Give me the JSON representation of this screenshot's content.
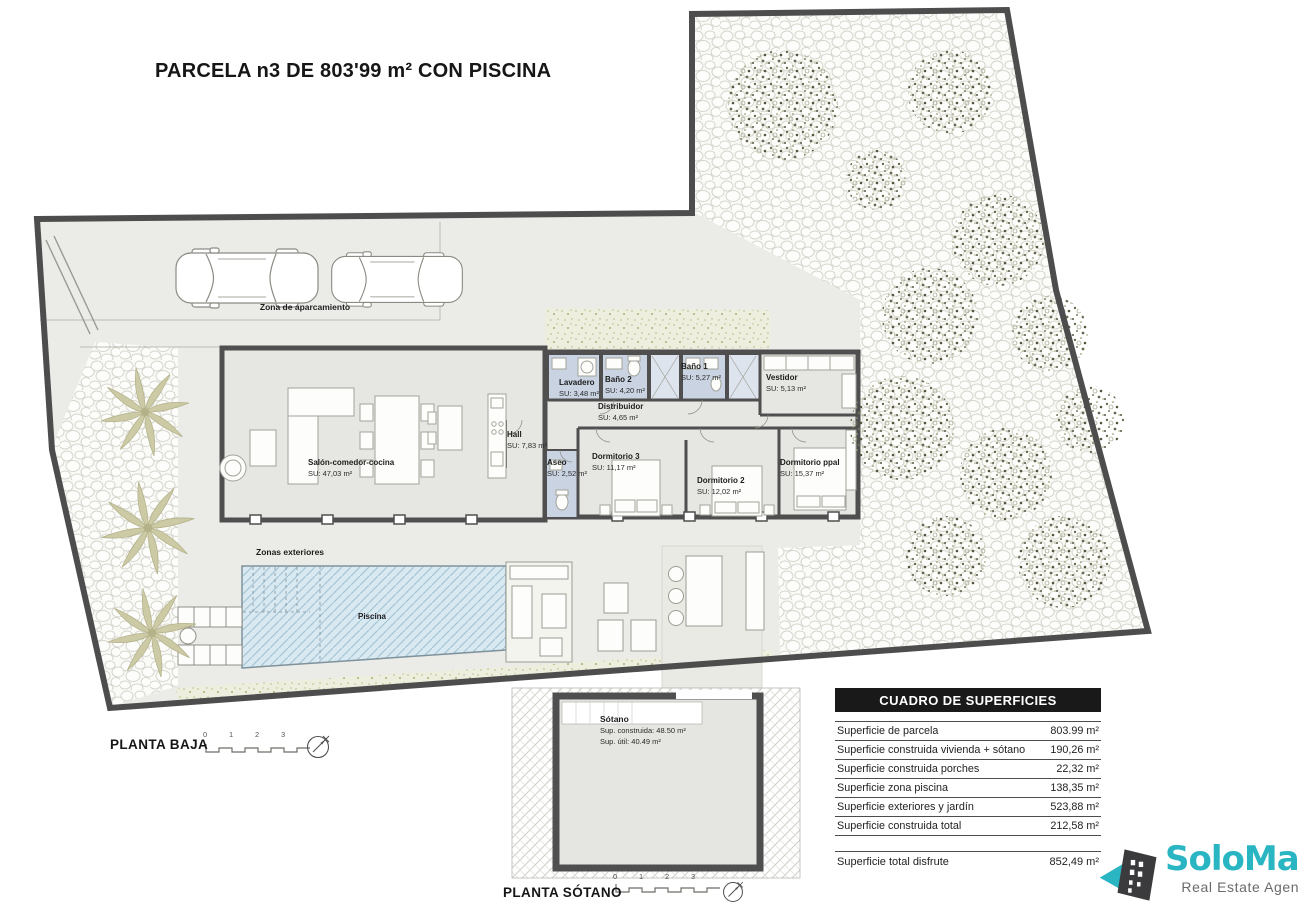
{
  "title": "PARCELA n3 DE 803'99 m² CON PISCINA",
  "plan_labels": {
    "parking": "Zona de aparcamiento",
    "exterior": "Zonas exteriores",
    "pool": "Piscina"
  },
  "rooms": [
    {
      "name": "Salón-comedor-cocina",
      "su": "SU: 47,03 m²"
    },
    {
      "name": "Hall",
      "su": "SU: 7,83 m²"
    },
    {
      "name": "Lavadero",
      "su": "SU: 3,48 m²"
    },
    {
      "name": "Baño 2",
      "su": "SU: 4,20 m²"
    },
    {
      "name": "Baño 1",
      "su": "SU: 5,27 m²"
    },
    {
      "name": "Vestidor",
      "su": "SU: 5,13 m²"
    },
    {
      "name": "Distribuidor",
      "su": "SU: 4,65 m²"
    },
    {
      "name": "Aseo",
      "su": "SU: 2,52 m²"
    },
    {
      "name": "Dormitorio 3",
      "su": "SU: 11,17 m²"
    },
    {
      "name": "Dormitorio 2",
      "su": "SU: 12,02 m²"
    },
    {
      "name": "Dormitorio ppal",
      "su": "SU: 15,37 m²"
    }
  ],
  "basement": {
    "name": "Sótano",
    "line1": "Sup. construida: 48.50 m²",
    "line2": "Sup. útil: 40.49 m²"
  },
  "floor_labels": {
    "ground": "PLANTA BAJA",
    "basement": "PLANTA SÓTANO"
  },
  "scale_ticks": [
    "0",
    "1",
    "2",
    "3"
  ],
  "table": {
    "header": "CUADRO DE SUPERFICIES",
    "rows": [
      {
        "label": "Superficie de parcela",
        "value": "803.99 m²"
      },
      {
        "label": "Superficie construida vivienda + sótano",
        "value": "190,26 m²"
      },
      {
        "label": "Superficie construida porches",
        "value": "22,32 m²"
      },
      {
        "label": "Superficie zona piscina",
        "value": "138,35 m²"
      },
      {
        "label": "Superficie exteriores y jardín",
        "value": "523,88 m²"
      },
      {
        "label": "Superficie construida total",
        "value": "212,58 m²"
      }
    ],
    "total_row": {
      "label": "Superficie total disfrute",
      "value": "852,49 m²"
    }
  },
  "logo": {
    "name": "SoloMar",
    "tagline": "Real Estate Agency",
    "teal": "#2ab5c3",
    "dark": "#3b3b3d"
  },
  "colors": {
    "wall": "#4f4f4f",
    "room_fill": "#e6e7e2",
    "wet_room_fill": "#c9d3e2",
    "pool_fill": "#d9e9f1",
    "paving": "#ebece8"
  }
}
